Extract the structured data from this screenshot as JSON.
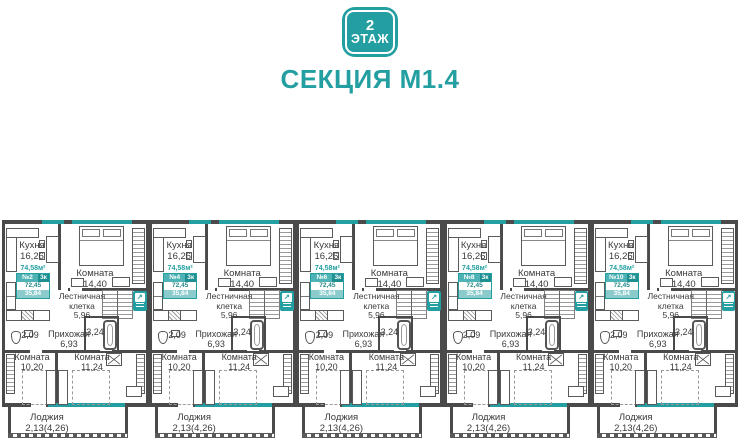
{
  "header": {
    "floor_number": "2",
    "floor_word": "ЭТАЖ",
    "section_title": "СЕКЦИЯ М1.4"
  },
  "plan": {
    "rooms": {
      "kitchen": {
        "name": "Кухня",
        "area": "16,26"
      },
      "bedroom": {
        "name": "Комната",
        "area": "14,40"
      },
      "stairwell": {
        "name_line1": "Лестничная",
        "name_line2": "клетка",
        "area": "5,96"
      },
      "hallway": {
        "name": "Прихожая",
        "area": "6,93"
      },
      "wc": {
        "area": "2,09"
      },
      "bathroom": {
        "area": "3,24"
      },
      "room_left": {
        "name": "Комната",
        "area": "10,20"
      },
      "room_right": {
        "name": "Комната",
        "area": "11,24"
      },
      "loggia": {
        "name": "Лоджия",
        "area": "2,13(4,26)"
      }
    },
    "apartment_card": {
      "total_area": "74,58м²",
      "rooms_count": "3к",
      "area_value": "72,45",
      "living_area": "35,84"
    },
    "units": [
      {
        "number": "№2"
      },
      {
        "number": "№4"
      },
      {
        "number": "№6"
      },
      {
        "number": "№8"
      },
      {
        "number": "№10"
      }
    ]
  },
  "icons": {
    "stairs_arrow": "↗"
  },
  "colors": {
    "teal": "#239FA1",
    "wall": "#4A4A4A"
  }
}
